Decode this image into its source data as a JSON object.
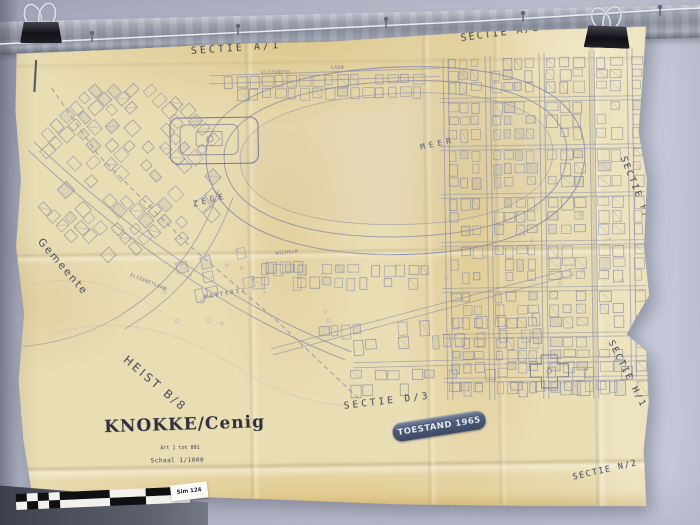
{
  "photo": {
    "stamp_label": "TOESTAND 1965",
    "scale_tag": "Sim 124"
  },
  "map": {
    "sections": {
      "a1": "SECTIE A/1",
      "a2": "SECTIE A/2",
      "f1": "SECTIE F/1",
      "h1": "SECTIE H/1",
      "n2": "SECTIE N/2",
      "d3": "SECTIE D/3"
    },
    "boundary": {
      "gemeente": "Gemeente",
      "heist": "HEIST B/8"
    },
    "water": {
      "zege": "ZEGE",
      "meer": "MEER"
    },
    "streets": {
      "elizabeth": "ELIZABETH",
      "laan": "LAAN",
      "elizabetlaan": "ELIZABETLAAN",
      "wilhelm": "WILHELM",
      "batterij": "BATTERIJ"
    },
    "title_block": {
      "title": "KNOKKE/Cenig",
      "line2": "Art 1 tot 801",
      "line3": "Schaal 1/1000"
    }
  },
  "colors": {
    "paper": "#e9ddb4",
    "ink": "#7b83a8",
    "label_ink": "#3f4457",
    "stamp_bg": "#4e5d78",
    "wall": "#c0c3d3"
  }
}
